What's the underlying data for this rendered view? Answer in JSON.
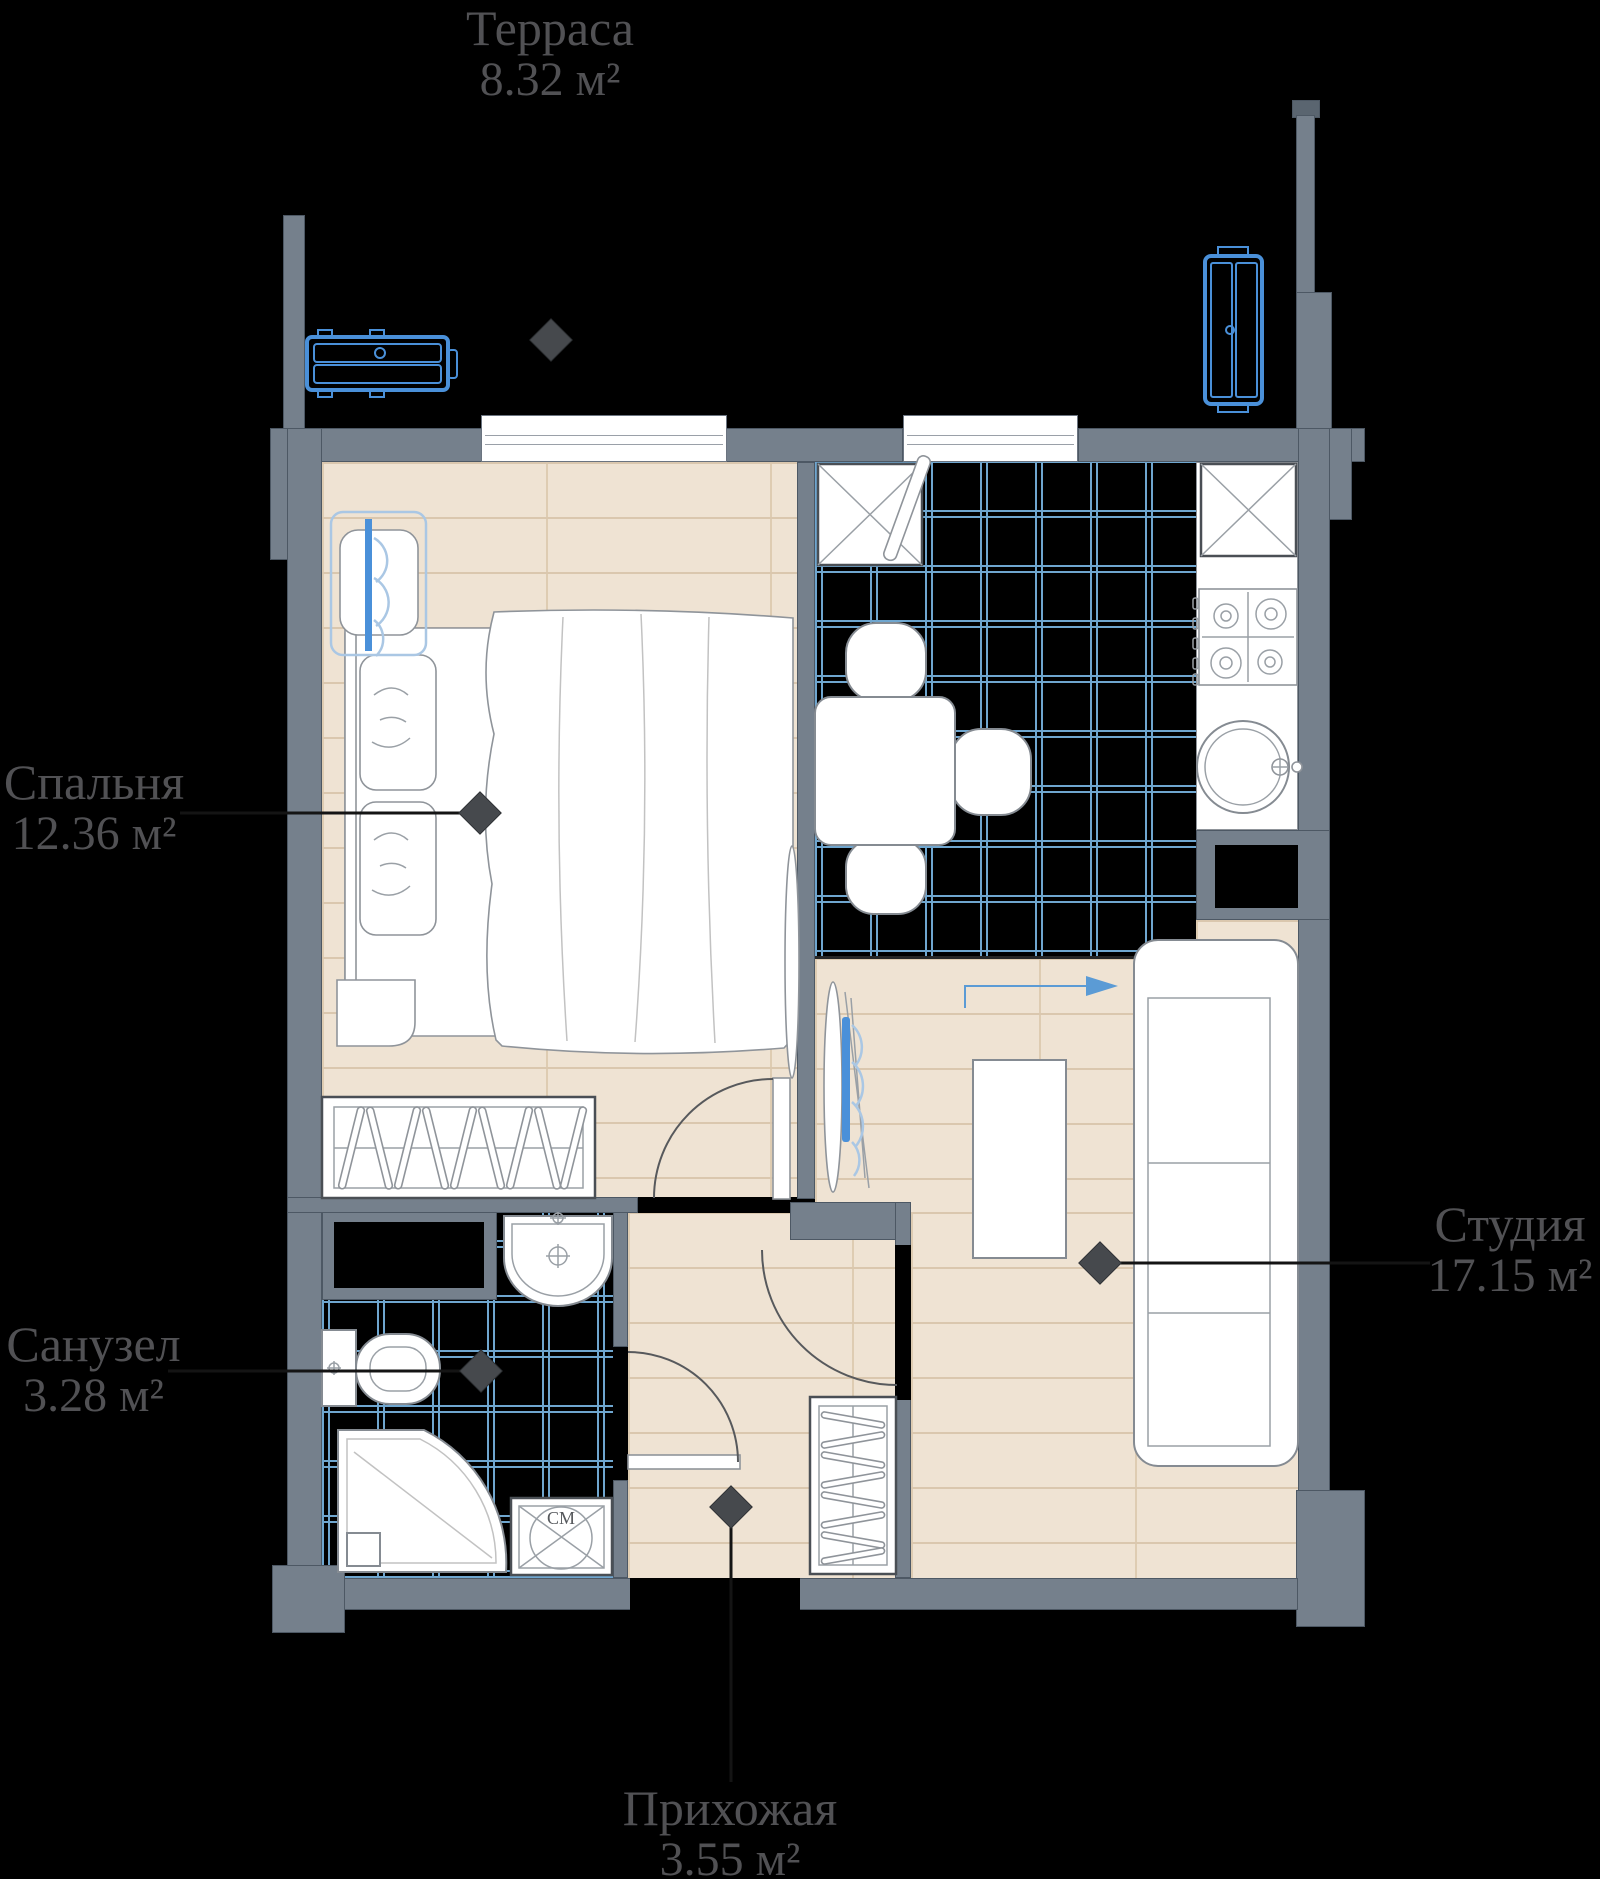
{
  "plan": {
    "rooms": {
      "terrace": {
        "name": "Терраса",
        "area": "8.32 м²"
      },
      "bedroom": {
        "name": "Спальня",
        "area": "12.36 м²"
      },
      "studio": {
        "name": "Студия",
        "area": "17.15 м²"
      },
      "bathroom": {
        "name": "Санузел",
        "area": "3.28 м²"
      },
      "hallway": {
        "name": "Прихожая",
        "area": "3.55 м²"
      }
    },
    "fixtures": {
      "washer_label": "СМ"
    },
    "colors": {
      "wall": "#75808C",
      "wall_edge": "#4D5864",
      "floor_wood": "#EFE3D3",
      "floor_wood_line": "#DAC7AE",
      "tile_line": "#6FA6CF",
      "accent_blue": "#4A90D9",
      "accent_blue_light": "#AAC7E4",
      "furniture_line": "#8F949A",
      "label_text": "#515154",
      "leader": "#141414",
      "diamond": "#46494D"
    }
  }
}
